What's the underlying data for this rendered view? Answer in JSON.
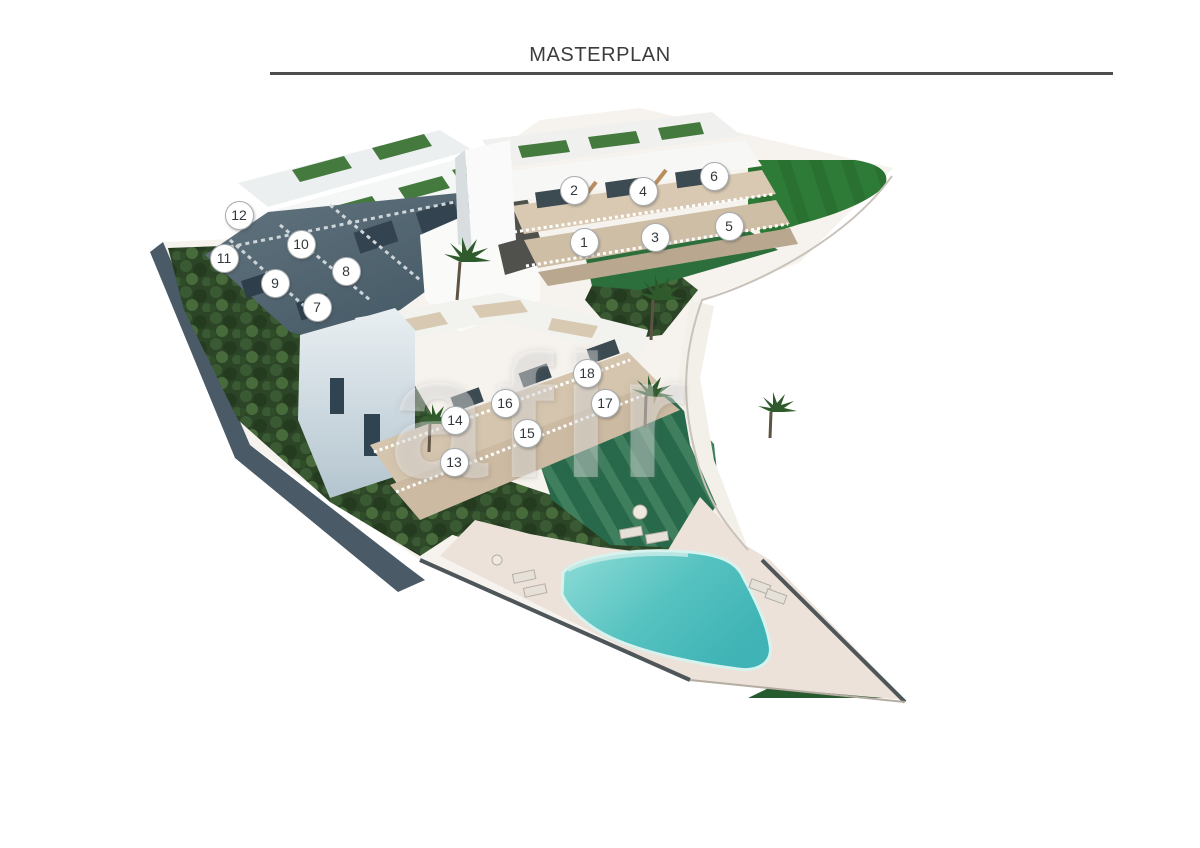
{
  "header": {
    "title": "MASTERPLAN"
  },
  "watermark": {
    "text": "afir"
  },
  "units": [
    {
      "label": "1",
      "x": 583,
      "y": 241
    },
    {
      "label": "2",
      "x": 573,
      "y": 189
    },
    {
      "label": "3",
      "x": 654,
      "y": 236
    },
    {
      "label": "4",
      "x": 642,
      "y": 190
    },
    {
      "label": "5",
      "x": 728,
      "y": 225
    },
    {
      "label": "6",
      "x": 713,
      "y": 175
    },
    {
      "label": "7",
      "x": 316,
      "y": 306
    },
    {
      "label": "8",
      "x": 345,
      "y": 270
    },
    {
      "label": "9",
      "x": 274,
      "y": 282
    },
    {
      "label": "10",
      "x": 300,
      "y": 243
    },
    {
      "label": "11",
      "x": 223,
      "y": 257
    },
    {
      "label": "12",
      "x": 238,
      "y": 214
    },
    {
      "label": "13",
      "x": 453,
      "y": 461
    },
    {
      "label": "14",
      "x": 454,
      "y": 419
    },
    {
      "label": "15",
      "x": 526,
      "y": 432
    },
    {
      "label": "16",
      "x": 504,
      "y": 402
    },
    {
      "label": "17",
      "x": 604,
      "y": 402
    },
    {
      "label": "18",
      "x": 586,
      "y": 372
    }
  ],
  "colors": {
    "title_text": "#3c3c3c",
    "rule_line": "#4d4d4d",
    "lawn_bright": "#2e7b38",
    "lawn_striped": "#27694a",
    "vegetation_dark": "#2c4527",
    "pool_light": "#8fdcd7",
    "pool_deep": "#3fb3b5",
    "deck": "#ece2d9",
    "terrace_beige": "#d6c6af",
    "building_white": "#f5f5f3",
    "building_shadow": "#50626f"
  }
}
